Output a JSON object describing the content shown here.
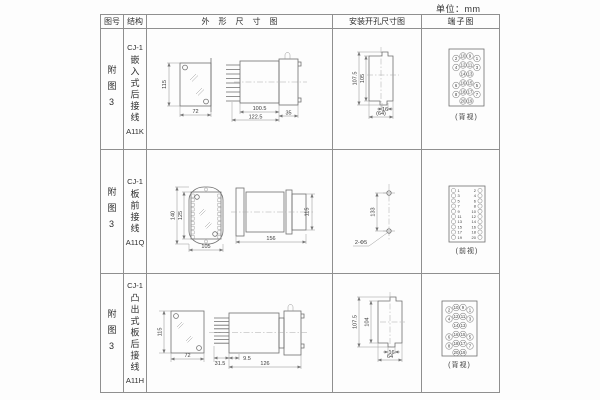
{
  "unit": "单位：mm",
  "headers": {
    "fig": "图号",
    "structure": "结构",
    "outline": "外形尺寸图",
    "mounting": "安装开孔尺寸图",
    "terminal": "端子图"
  },
  "rows": [
    {
      "fig": "附图3",
      "model": "CJ-1",
      "structure": "嵌入式后接线",
      "code": "A11K",
      "outline": {
        "h": "115",
        "w": "72",
        "body": "100.5",
        "total": "122.5",
        "front": "35"
      },
      "mounting": {
        "outer": "107.5",
        "inner": "105",
        "notch": "16",
        "width": "(64)"
      },
      "terminal": {
        "caption": "(背视)"
      }
    },
    {
      "fig": "附图3",
      "model": "CJ-1",
      "structure": "板前接线",
      "code": "A11Q",
      "outline": {
        "outer_h": "140",
        "inner_h": "125",
        "w": "105",
        "len": "156",
        "h": "115"
      },
      "mounting": {
        "pitch": "133",
        "holes": "2-Φ5"
      },
      "terminal": {
        "caption": "(前视)"
      }
    },
    {
      "fig": "附图3",
      "model": "CJ-1",
      "structure": "凸出式板后接线",
      "code": "A11H",
      "outline": {
        "h": "115",
        "w": "72",
        "pins": "31.5",
        "offset": "9.5",
        "len": "126"
      },
      "mounting": {
        "outer": "107.5",
        "inner": "104",
        "notch": "16",
        "width": "64"
      },
      "terminal": {
        "caption": "(背视)"
      }
    }
  ],
  "terminals": {
    "back_rows": [
      [
        "2",
        "10",
        "9",
        "1"
      ],
      [
        "4",
        "12",
        "11",
        "3"
      ],
      [
        "",
        "14",
        "13",
        ""
      ],
      [
        "6",
        "16",
        "15",
        "5"
      ],
      [
        "8",
        "18",
        "17",
        "7"
      ],
      [
        "",
        "20",
        "19",
        ""
      ]
    ],
    "front_left": [
      "1",
      "3",
      "5",
      "7",
      "9",
      "11",
      "13",
      "15",
      "17",
      "19"
    ],
    "front_right": [
      "2",
      "4",
      "6",
      "8",
      "10",
      "12",
      "14",
      "16",
      "18",
      "20"
    ]
  }
}
